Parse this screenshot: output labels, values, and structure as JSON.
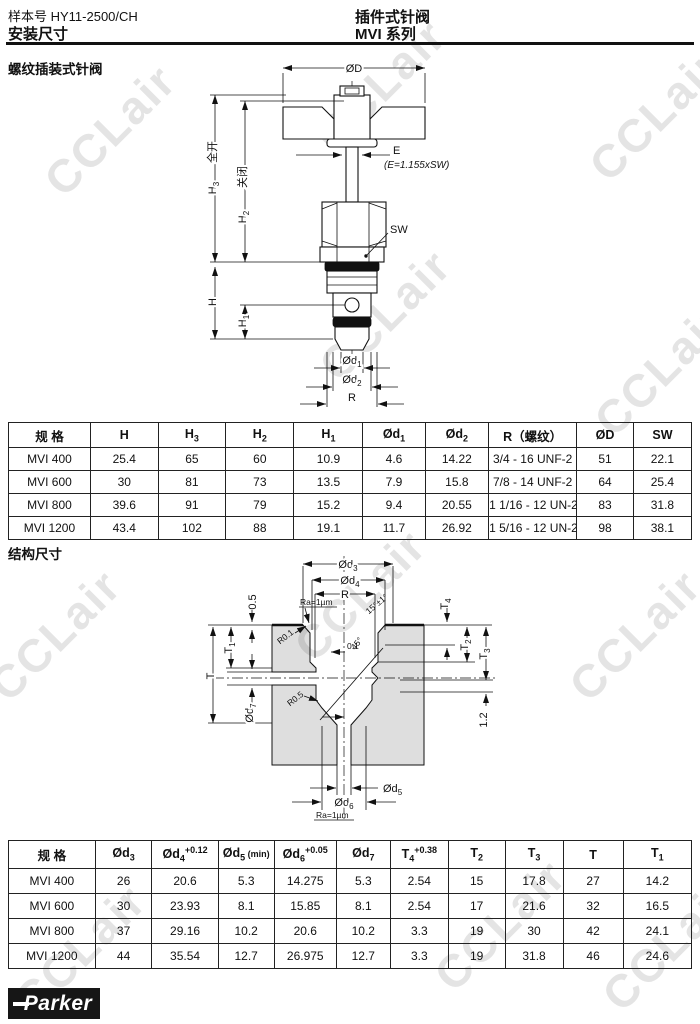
{
  "header": {
    "doc_no": "样本号 HY11-2500/CH",
    "left_subtitle": "安装尺寸",
    "right_title": "插件式针阀",
    "series_bold": "MVI",
    "series_rest": " 系列"
  },
  "watermark": {
    "text": "CCLair",
    "color": "#e4e4e4"
  },
  "section1": {
    "title": "螺纹插装式针阀",
    "labels": {
      "od": "ØD",
      "full_open": "全开",
      "close": "关闭",
      "h3b": "H",
      "h3s": "3",
      "h2b": "H",
      "h2s": "2",
      "e": "E",
      "e_note": "(E=1.155xSW)",
      "sw": "SW",
      "h": "H",
      "h1b": "H",
      "h1s": "1",
      "od1b": "Ød",
      "od1s": "1",
      "od2b": "Ød",
      "od2s": "2",
      "r": "R"
    }
  },
  "table1": {
    "col_widths": [
      12,
      9.9,
      9.9,
      10,
      10.1,
      9.1,
      9.3,
      12.9,
      8.3,
      8.5
    ],
    "headers": [
      {
        "b": "规 格"
      },
      {
        "b": "H"
      },
      {
        "b": "H",
        "sub": "3"
      },
      {
        "b": "H",
        "sub": "2"
      },
      {
        "b": "H",
        "sub": "1"
      },
      {
        "b": "Ød",
        "sub": "1"
      },
      {
        "b": "Ød",
        "sub": "2"
      },
      {
        "b": "R（螺纹）"
      },
      {
        "b": "ØD"
      },
      {
        "b": "SW"
      }
    ],
    "rows": [
      [
        "MVI 400",
        "25.4",
        "65",
        "60",
        "10.9",
        "4.6",
        "14.22",
        "3/4 - 16 UNF-2",
        "51",
        "22.1"
      ],
      [
        "MVI 600",
        "30",
        "81",
        "73",
        "13.5",
        "7.9",
        "15.8",
        "7/8 - 14 UNF-2",
        "64",
        "25.4"
      ],
      [
        "MVI 800",
        "39.6",
        "91",
        "79",
        "15.2",
        "9.4",
        "20.55",
        "1 1/16 - 12 UN-2",
        "83",
        "31.8"
      ],
      [
        "MVI 1200",
        "43.4",
        "102",
        "88",
        "19.1",
        "11.7",
        "26.92",
        "1 5/16 - 12 UN-2",
        "98",
        "38.1"
      ]
    ]
  },
  "section2": {
    "title": "结构尺寸",
    "labels": {
      "od3b": "Ød",
      "od3s": "3",
      "od4b": "Ød",
      "od4s": "4",
      "r": "R",
      "ra": "Ra=1µm",
      "a15": "15°±1°",
      "a45": "45°",
      "r01": "R0.1",
      "r05": "R0.5",
      "tol": "0.1",
      "half": "0.5",
      "t1b": "T",
      "t1s": "1",
      "t": "T",
      "od7b": "Ød",
      "od7s": "7",
      "t4b": "T",
      "t4s": "4",
      "t2b": "T",
      "t2s": "2",
      "t3b": "T",
      "t3s": "3",
      "d12": "1.2",
      "od5b": "Ød",
      "od5s": "5",
      "od6b": "Ød",
      "od6s": "6",
      "ra2": "Ra=1µm"
    }
  },
  "table2": {
    "col_widths": [
      12.7,
      8.3,
      9.7,
      8.2,
      9.1,
      7.9,
      8.5,
      8.3,
      8.5,
      8.8,
      10
    ],
    "headers": [
      {
        "b": "规 格"
      },
      {
        "b": "Ød",
        "sub": "3"
      },
      {
        "b": "Ød",
        "sub": "4",
        "sup": "+0.12"
      },
      {
        "b": "Ød",
        "sub": "5",
        "note": "(min)"
      },
      {
        "b": "Ød",
        "sub": "6",
        "sup": "+0.05"
      },
      {
        "b": "Ød",
        "sub": "7"
      },
      {
        "b": "T",
        "sub": "4",
        "sup": "+0.38"
      },
      {
        "b": "T",
        "sub": "2"
      },
      {
        "b": "T",
        "sub": "3"
      },
      {
        "b": "T"
      },
      {
        "b": "T",
        "sub": "1"
      }
    ],
    "rows": [
      [
        "MVI 400",
        "26",
        "20.6",
        "5.3",
        "14.275",
        "5.3",
        "2.54",
        "15",
        "17.8",
        "27",
        "14.2"
      ],
      [
        "MVI 600",
        "30",
        "23.93",
        "8.1",
        "15.85",
        "8.1",
        "2.54",
        "17",
        "21.6",
        "32",
        "16.5"
      ],
      [
        "MVI 800",
        "37",
        "29.16",
        "10.2",
        "20.6",
        "10.2",
        "3.3",
        "19",
        "30",
        "42",
        "24.1"
      ],
      [
        "MVI 1200",
        "44",
        "35.54",
        "12.7",
        "26.975",
        "12.7",
        "3.3",
        "19",
        "31.8",
        "46",
        "24.6"
      ]
    ]
  },
  "footer": {
    "logo_text": "Parker"
  }
}
